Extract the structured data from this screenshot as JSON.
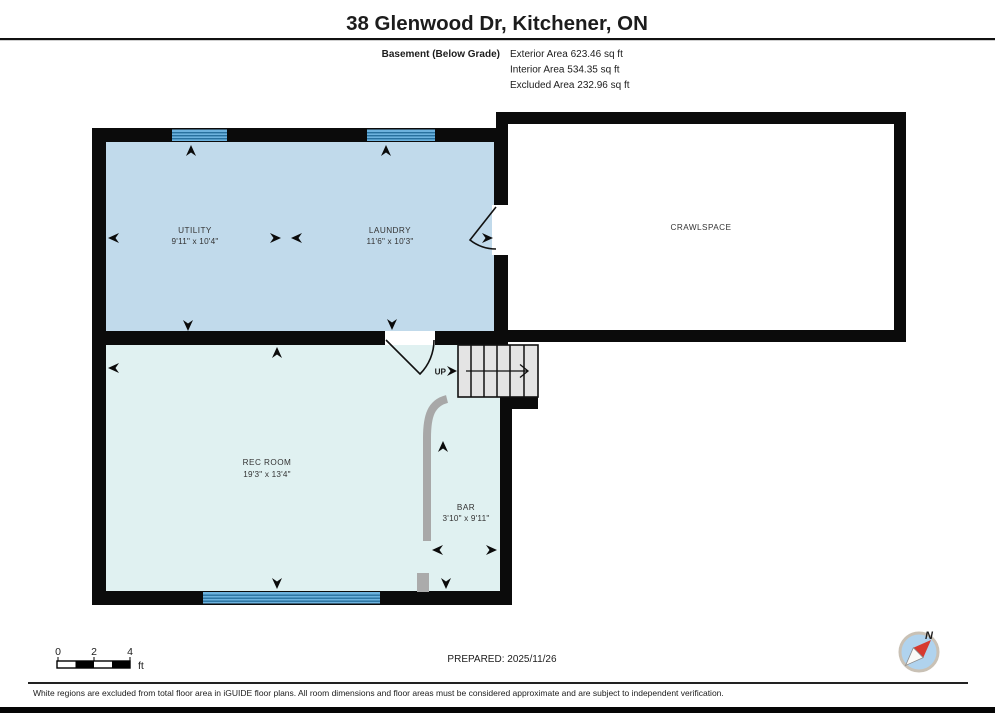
{
  "header": {
    "title": "38 Glenwood Dr, Kitchener, ON",
    "floor_label": "Basement (Below Grade)",
    "exterior_area": "Exterior Area 623.46 sq ft",
    "interior_area": "Interior Area 534.35 sq ft",
    "excluded_area": "Excluded Area 232.96 sq ft"
  },
  "rooms": {
    "utility": {
      "name": "UTILITY",
      "dims": "9'11\" x 10'4\""
    },
    "laundry": {
      "name": "LAUNDRY",
      "dims": "11'6\" x 10'3\""
    },
    "crawlspace": {
      "name": "CRAWLSPACE",
      "dims": ""
    },
    "rec_room": {
      "name": "REC ROOM",
      "dims": "19'3\" x 13'4\""
    },
    "bar": {
      "name": "BAR",
      "dims": "3'10\" x 9'11\""
    }
  },
  "stairs": {
    "up_label": "UP"
  },
  "scale_bar": {
    "tick0": "0",
    "tick2": "2",
    "tick4": "4",
    "unit": "ft"
  },
  "compass": {
    "north_label": "N"
  },
  "footer": {
    "prepared": "PREPARED: 2025/11/26",
    "disclaimer": "White regions are excluded from total floor area in iGUIDE floor plans. All room dimensions and floor areas must be considered approximate and are subject to independent verification."
  },
  "colors": {
    "wall": "#0b0b0b",
    "room_fill_blue": "#c1daeb",
    "room_fill_cyan": "#e0f1f1",
    "window_band": "#6cb2de",
    "window_stripe": "#28719f",
    "stairs_fill": "#e4e4e4",
    "counter_gray": "#a8a8a8",
    "compass_face": "#b0d3ee",
    "compass_needle_red": "#d63a30"
  }
}
